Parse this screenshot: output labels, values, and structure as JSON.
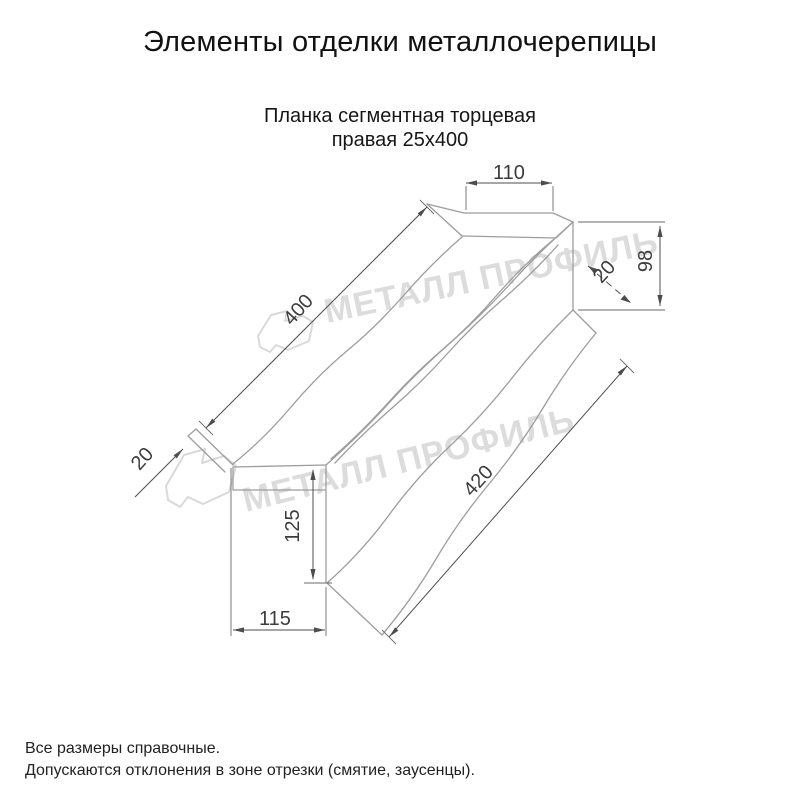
{
  "page": {
    "title": "Элементы отделки металлочерепицы"
  },
  "product": {
    "name_line1": "Планка сегментная торцевая",
    "name_line2": "правая 25х400"
  },
  "drawing": {
    "type": "technical-dimension-drawing",
    "units": "mm",
    "dimensions": {
      "top_face_width": "110",
      "end_cap_height": "98",
      "hem_top_right": "20",
      "length_top_edge": "400",
      "length_bottom_edge": "420",
      "hem_bottom_left": "20",
      "side_drop": "125",
      "bottom_face_width": "115"
    }
  },
  "watermark": {
    "text": "МЕТАЛЛ ПРОФИЛЬ",
    "logo": "metall-profil-flag"
  },
  "notes": {
    "line1": "Все размеры справочные.",
    "line2": "Допускаются отклонения в зоне отрезки (смятие, заусенцы)."
  },
  "colors": {
    "background": "#ffffff",
    "part_line": "#9d9d9d",
    "dimension_line": "#4d4d4d",
    "text": "#1c1c1c",
    "watermark": "#dcdcdc"
  }
}
